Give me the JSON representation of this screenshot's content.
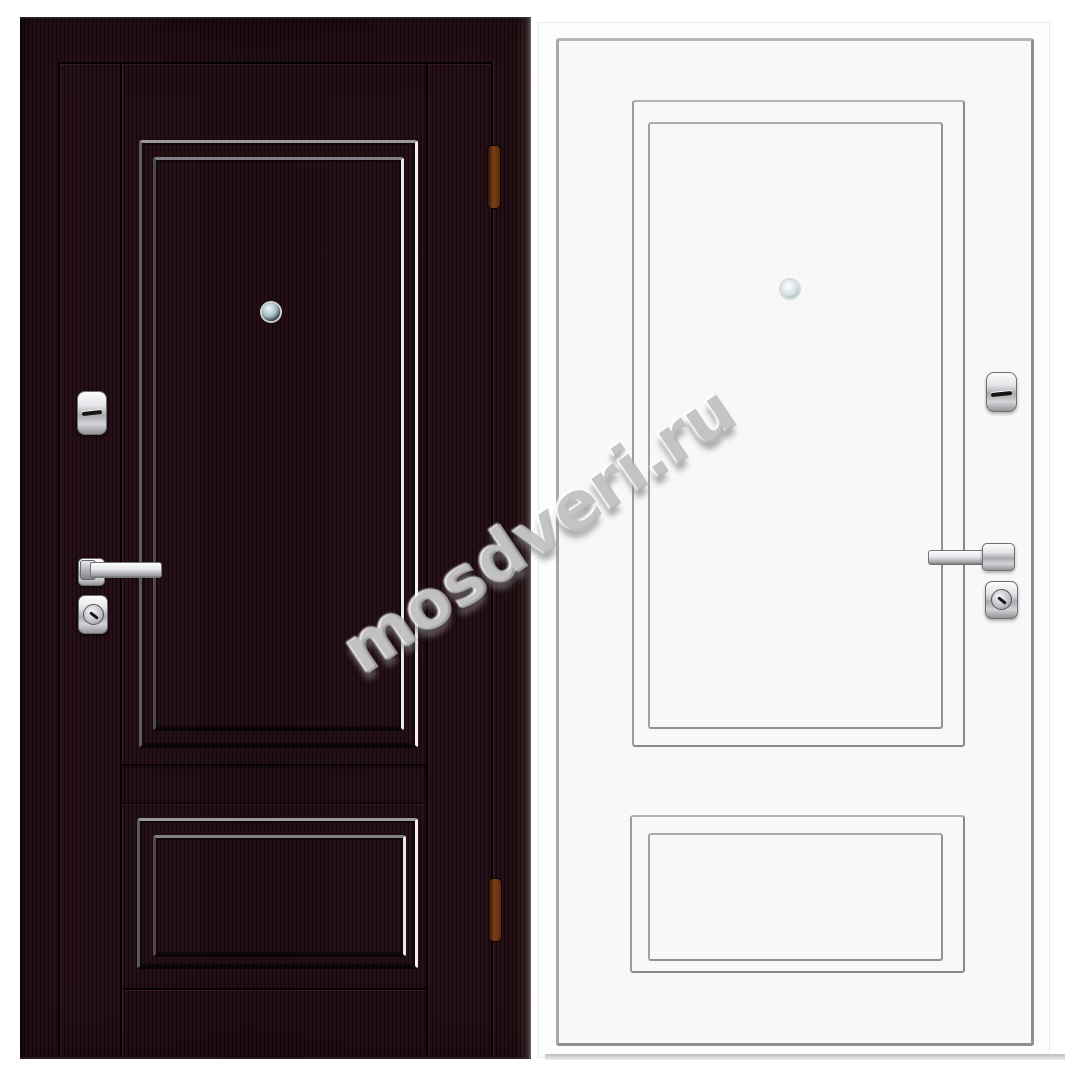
{
  "watermark": {
    "text": "mosdveri.ru"
  },
  "colors": {
    "background": "#ffffff",
    "dark_door_base": "#1d0d12",
    "white_door_fill": "#f8f8f9",
    "white_door_line": "#8a8a8d",
    "hinge_brown": "#7c4015",
    "shadow_gray": "#bdbdbd"
  }
}
